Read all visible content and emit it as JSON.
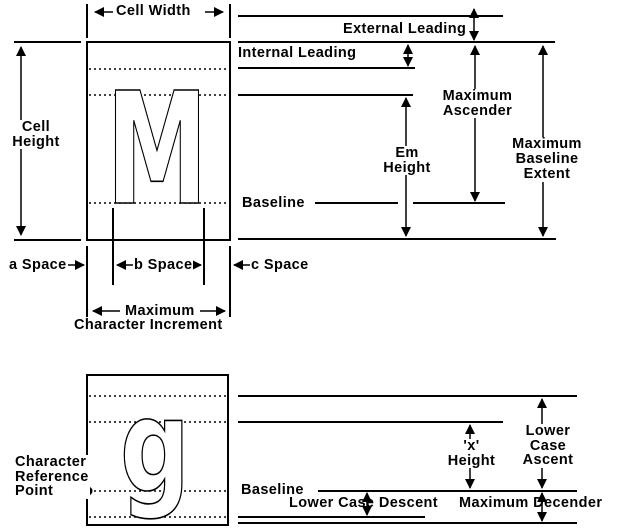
{
  "colors": {
    "ink": "#000000",
    "background": "#ffffff"
  },
  "glyphs": {
    "uppercase": "M",
    "lowercase": "g"
  },
  "top_diagram": {
    "labels": {
      "cell_width": "Cell Width",
      "external_leading": "External Leading",
      "internal_leading": "Internal Leading",
      "maximum_ascender": "Maximum\nAscender",
      "em_height": "Em\nHeight",
      "cell_height": "Cell\nHeight",
      "baseline": "Baseline",
      "maximum_baseline_extent": "Maximum\nBaseline\nExtent",
      "a_space": "a Space",
      "b_space": "b Space",
      "c_space": "c Space",
      "maximum": "Maximum",
      "character_increment": "Character Increment"
    }
  },
  "bottom_diagram": {
    "labels": {
      "character_reference_point": "Character\nReference\nPoint",
      "x_height": "'x'\nHeight",
      "lower_case_ascent": "Lower\nCase\nAscent",
      "baseline": "Baseline",
      "lower_case_descent": "Lower Case Descent",
      "maximum_decender": "Maximum Decender"
    }
  }
}
